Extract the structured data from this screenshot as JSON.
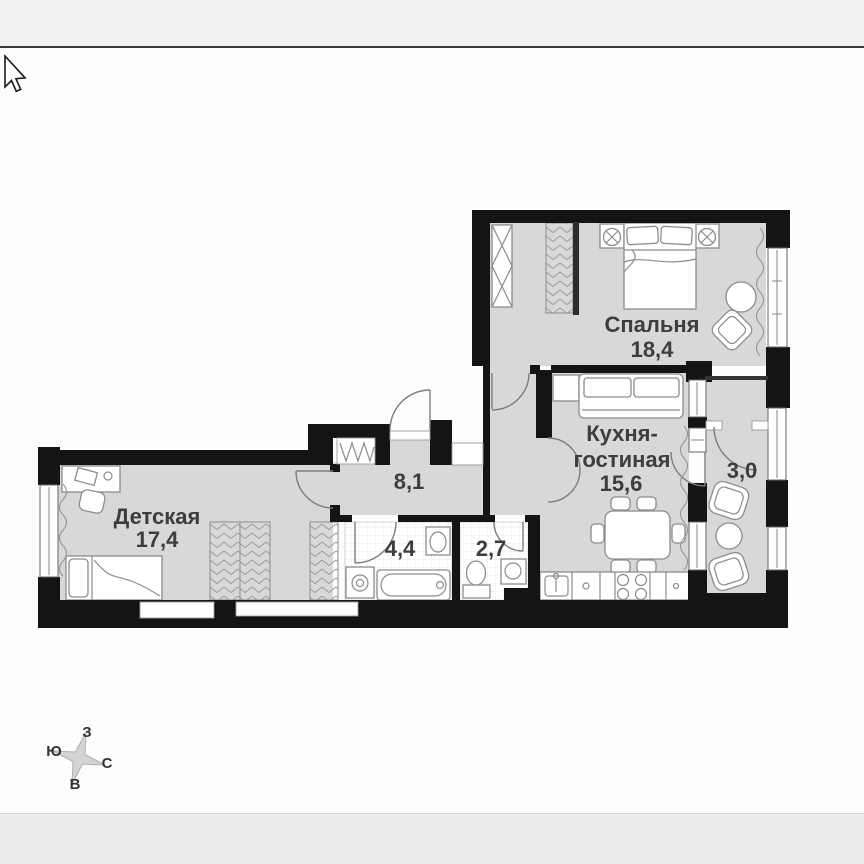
{
  "viewer": {
    "cursor": "arrow-pointer",
    "top_bar": "empty",
    "bottom_bar": "empty"
  },
  "plan": {
    "type": "apartment-floor-plan",
    "rooms": [
      {
        "id": "bedroom",
        "name": "Спальня",
        "area": "18,4"
      },
      {
        "id": "kitchen_living",
        "name_line1": "Кухня-",
        "name_line2": "гостиная",
        "area": "15,6"
      },
      {
        "id": "hallway",
        "area": "8,1"
      },
      {
        "id": "children",
        "name": "Детская",
        "area": "17,4"
      },
      {
        "id": "bathroom",
        "area": "4,4"
      },
      {
        "id": "toilet",
        "area": "2,7"
      },
      {
        "id": "balcony",
        "area": "3,0"
      }
    ],
    "colors": {
      "wall": "#141414",
      "floor": "#d8d8d6",
      "tile": "#ffffff",
      "furniture_stroke": "#8c8c8c",
      "label": "#3d3d3d",
      "compass_star": "#d4d4d2"
    }
  },
  "compass": {
    "north": "С",
    "south": "Ю",
    "west": "З",
    "east": "В"
  }
}
